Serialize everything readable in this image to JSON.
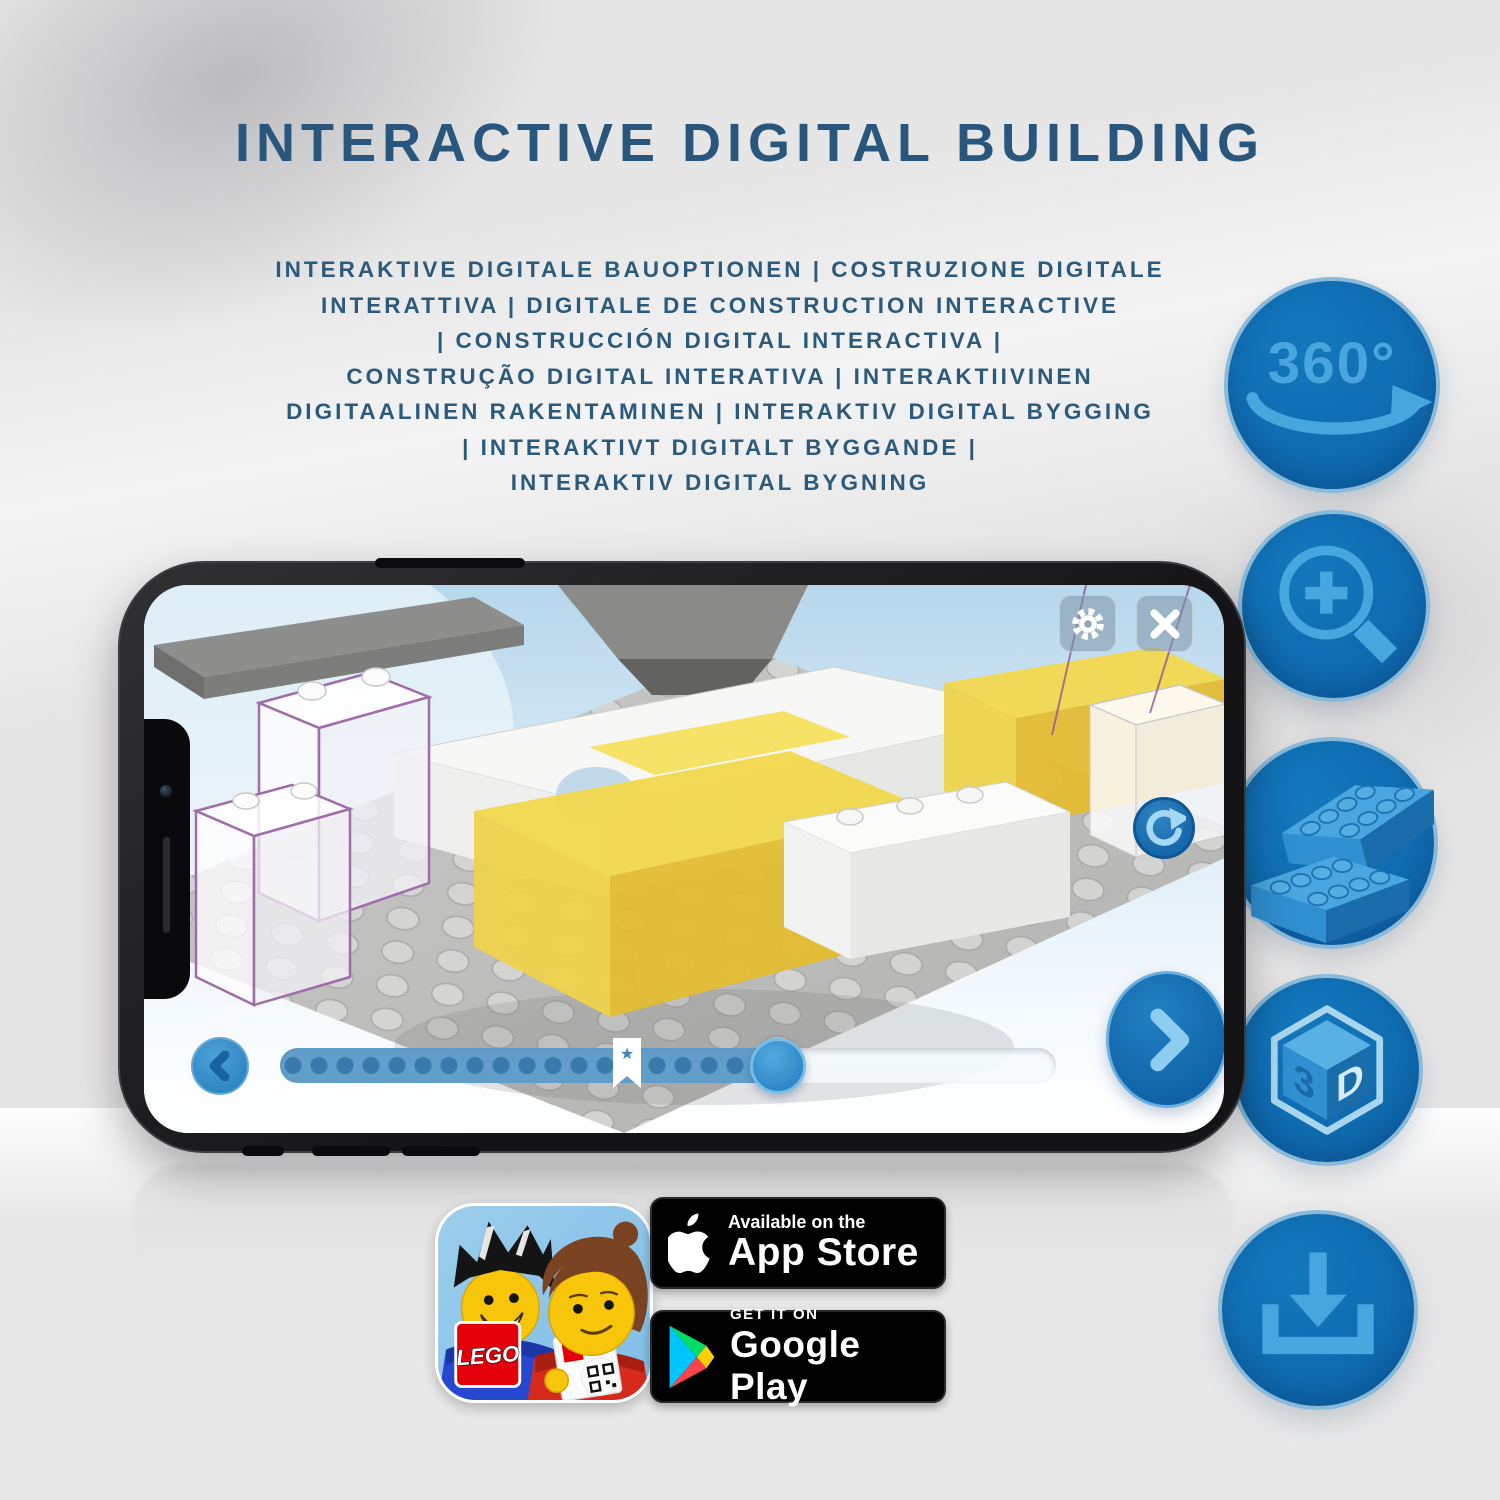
{
  "page": {
    "title": "INTERACTIVE DIGITAL BUILDING",
    "subtitle_lines": [
      "INTERAKTIVE DIGITALE BAUOPTIONEN | COSTRUZIONE DIGITALE",
      "INTERATTIVA | DIGITALE DE CONSTRUCTION INTERACTIVE",
      "| CONSTRUCCIÓN DIGITAL INTERACTIVA |",
      "CONSTRUÇÃO DIGITAL INTERATIVA | INTERAKTIIVINEN",
      "DIGITAALINEN RAKENTAMINEN | INTERAKTIV DIGITAL BYGGING",
      "| INTERAKTIVT DIGITALT BYGGANDE |",
      "INTERAKTIV DIGITAL BYGNING"
    ]
  },
  "feature_icons": {
    "rotation_label": "360°",
    "cube_left": "3",
    "cube_right": "D",
    "items": [
      {
        "name": "360-rotation"
      },
      {
        "name": "zoom-in"
      },
      {
        "name": "lego-brick"
      },
      {
        "name": "3d-cube"
      },
      {
        "name": "download"
      }
    ]
  },
  "phone": {
    "app_ui": {
      "progress_percent": 63,
      "bookmark_percent": 45,
      "bookmark_star": "★",
      "controls": [
        "settings",
        "close",
        "rotate-view",
        "previous-step",
        "next-step",
        "progress-slider"
      ]
    }
  },
  "store": {
    "app_icon_logo": "LEGO",
    "app_store": {
      "tagline": "Available on the",
      "name": "App Store"
    },
    "google_play": {
      "tagline": "GET IT ON",
      "name": "Google Play"
    }
  },
  "colors": {
    "title_blue": "#29567d",
    "badge_circle_blue": "#1072b8",
    "icon_light_blue": "#47a6de",
    "lego_red": "#e3000b",
    "brick_yellow": "#f2d94e",
    "background_gray": "#e7e6e6"
  }
}
